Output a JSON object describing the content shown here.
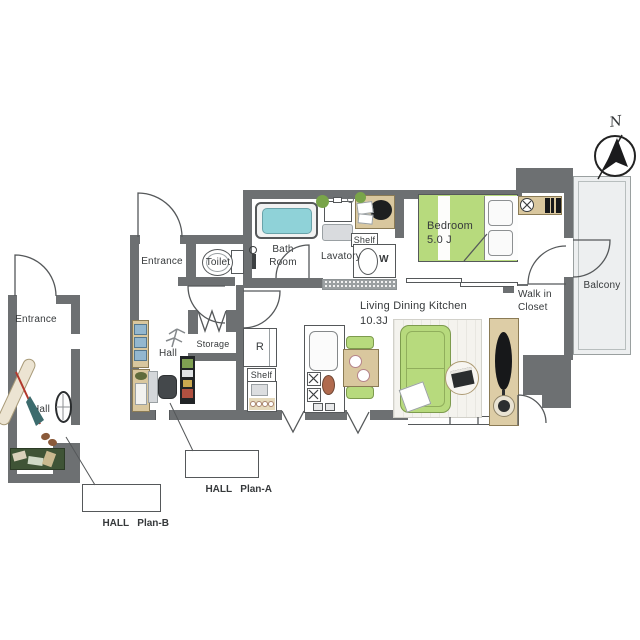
{
  "colors": {
    "wall": "#6d7072",
    "line": "#55585a",
    "text": "#36393b",
    "tub": "#8fd2d8",
    "green": "#b7da7d",
    "green-dark": "#7d9b4e",
    "wood": "#d9c79e",
    "wood-dark": "#8b7b55",
    "balcony": "#edeff0",
    "rug": "#f4f3ee",
    "dark": "#1d1f20"
  },
  "compass": {
    "north": "N"
  },
  "main": {
    "entrance": "Entrance",
    "toilet": "Toilet",
    "bath_line1": "Bath",
    "bath_line2": "Room",
    "lavatory": "Lavatory",
    "shelf_top": "Shelf",
    "washer": "W",
    "bedroom": "Bedroom",
    "bedroom_size": "5.0 J",
    "wic_line1": "Walk in",
    "wic_line2": "Closet",
    "balcony": "Balcony",
    "hall": "Hall",
    "storage": "Storage",
    "fridge": "R",
    "shelf_bottom": "Shelf",
    "ldk": "Living Dining Kitchen",
    "ldk_size": "10.3J"
  },
  "plan_b": {
    "entrance": "Entrance",
    "hall": "Hall"
  },
  "callouts": {
    "plan_a": "HALL   Plan-A",
    "plan_b": "HALL   Plan-B"
  }
}
